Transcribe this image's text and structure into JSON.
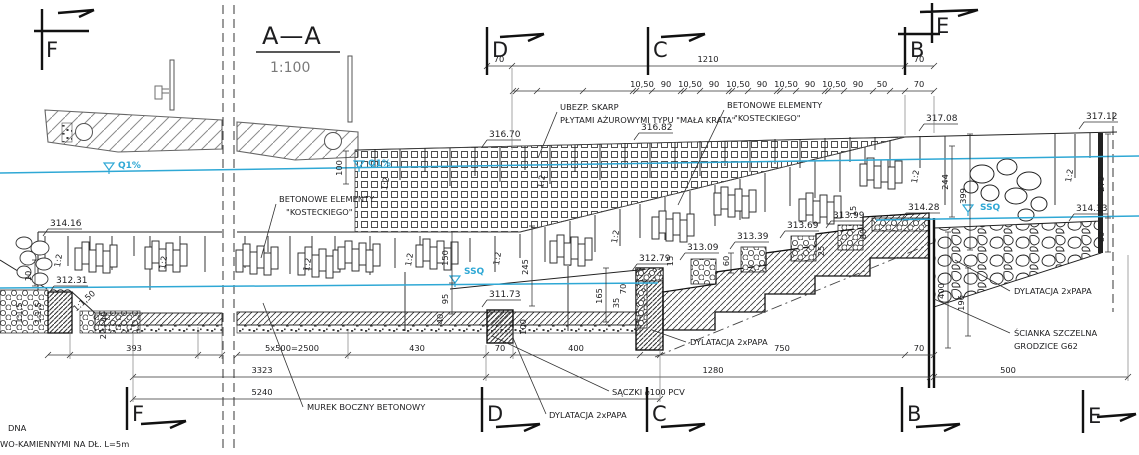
{
  "title": {
    "section": "A—A",
    "scale": "1:100"
  },
  "markers": {
    "f": "F",
    "d": "D",
    "c": "C",
    "b": "B",
    "e": "E"
  },
  "water": {
    "q1": "Q1%",
    "ssq": "SSQ"
  },
  "elevations": {
    "el31416": "314.16",
    "el31231": "312.31",
    "el31670": "316.70",
    "el31682": "316.82",
    "el31708": "317.08",
    "el31712": "317.12",
    "el31173": "311.73",
    "el31279": "312.79",
    "el31309": "313.09",
    "el31339": "313.39",
    "el31369": "313.69",
    "el31399": "313.99",
    "el31428": "314.28",
    "el31433": "314.33"
  },
  "annotations": {
    "ubezp1": "UBEZP. SKARP",
    "ubezp2": "PŁYTAMI AŻUROWYMI TYPU \"MAŁA KRATA\"",
    "beton1": "BETONOWE ELEMENTY",
    "beton2": "\"KOSTECKIEGO\"",
    "murek": "MUREK BOCZNY BETONOWY",
    "dylatacja": "DYLATACJA 2xPAPA",
    "saczki": "SĄCZKI ⌀100 PCV",
    "scianka1": "ŚCIANKA SZCZELNA",
    "scianka2": "GRODZICE G62",
    "note1": "DNA",
    "note2": "WO-KAMIENNYMI NA DŁ. L=5m"
  },
  "dims": {
    "h70": "70",
    "h1210": "1210",
    "mod_a": "10,50",
    "mod_b": "90",
    "h50": "50",
    "b393": "393",
    "b2500": "5x500=2500",
    "b430": "430",
    "b400": "400",
    "b750": "750",
    "b500": "500",
    "b3323": "3323",
    "b1280": "1280",
    "b5240": "5240",
    "v10": "10",
    "v20": "20",
    "v40": "40",
    "v95": "95",
    "v100": "100",
    "v150": "150",
    "v165": "165",
    "v245": "245",
    "v35": "35",
    "v70": "70",
    "v15": "15",
    "v60": "60",
    "v25": "25",
    "v80": "80",
    "v244": "244",
    "v279": "279",
    "v399": "399",
    "v400": "400",
    "v196": "196"
  },
  "slopes": {
    "s12": "1:2",
    "s115": "1:1,5",
    "s1150": "1:1,50"
  },
  "colors": {
    "water": "#2fa8d5",
    "ink": "#1d1d1f",
    "muted": "#7a7a7a"
  }
}
